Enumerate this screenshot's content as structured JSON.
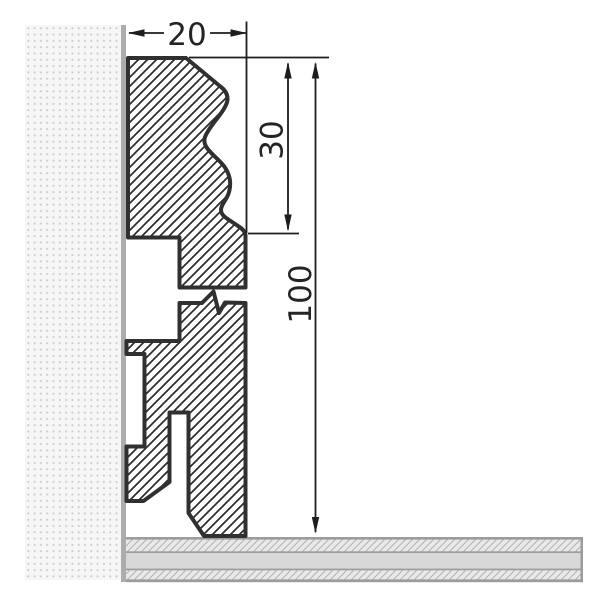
{
  "drawing": {
    "dimensions": {
      "width": {
        "label": "20"
      },
      "upper_height": {
        "label": "30"
      },
      "total_height": {
        "label": "100"
      }
    }
  },
  "colors": {
    "paper": "#ffffff",
    "outline": "#303030",
    "hatch_line": "#2b2b2b",
    "wall_bg": "#f6f6f6",
    "wall_dot": "#c9c9c9",
    "wall_edge": "#acacac",
    "floor_band": "#d8d8d8",
    "floor_hatch_bg": "#e9e9e9",
    "floor_hatch_line": "#b4b4b4",
    "floor_border": "#9c9c9c",
    "dim": "#1d1d1d",
    "text": "#242424"
  }
}
